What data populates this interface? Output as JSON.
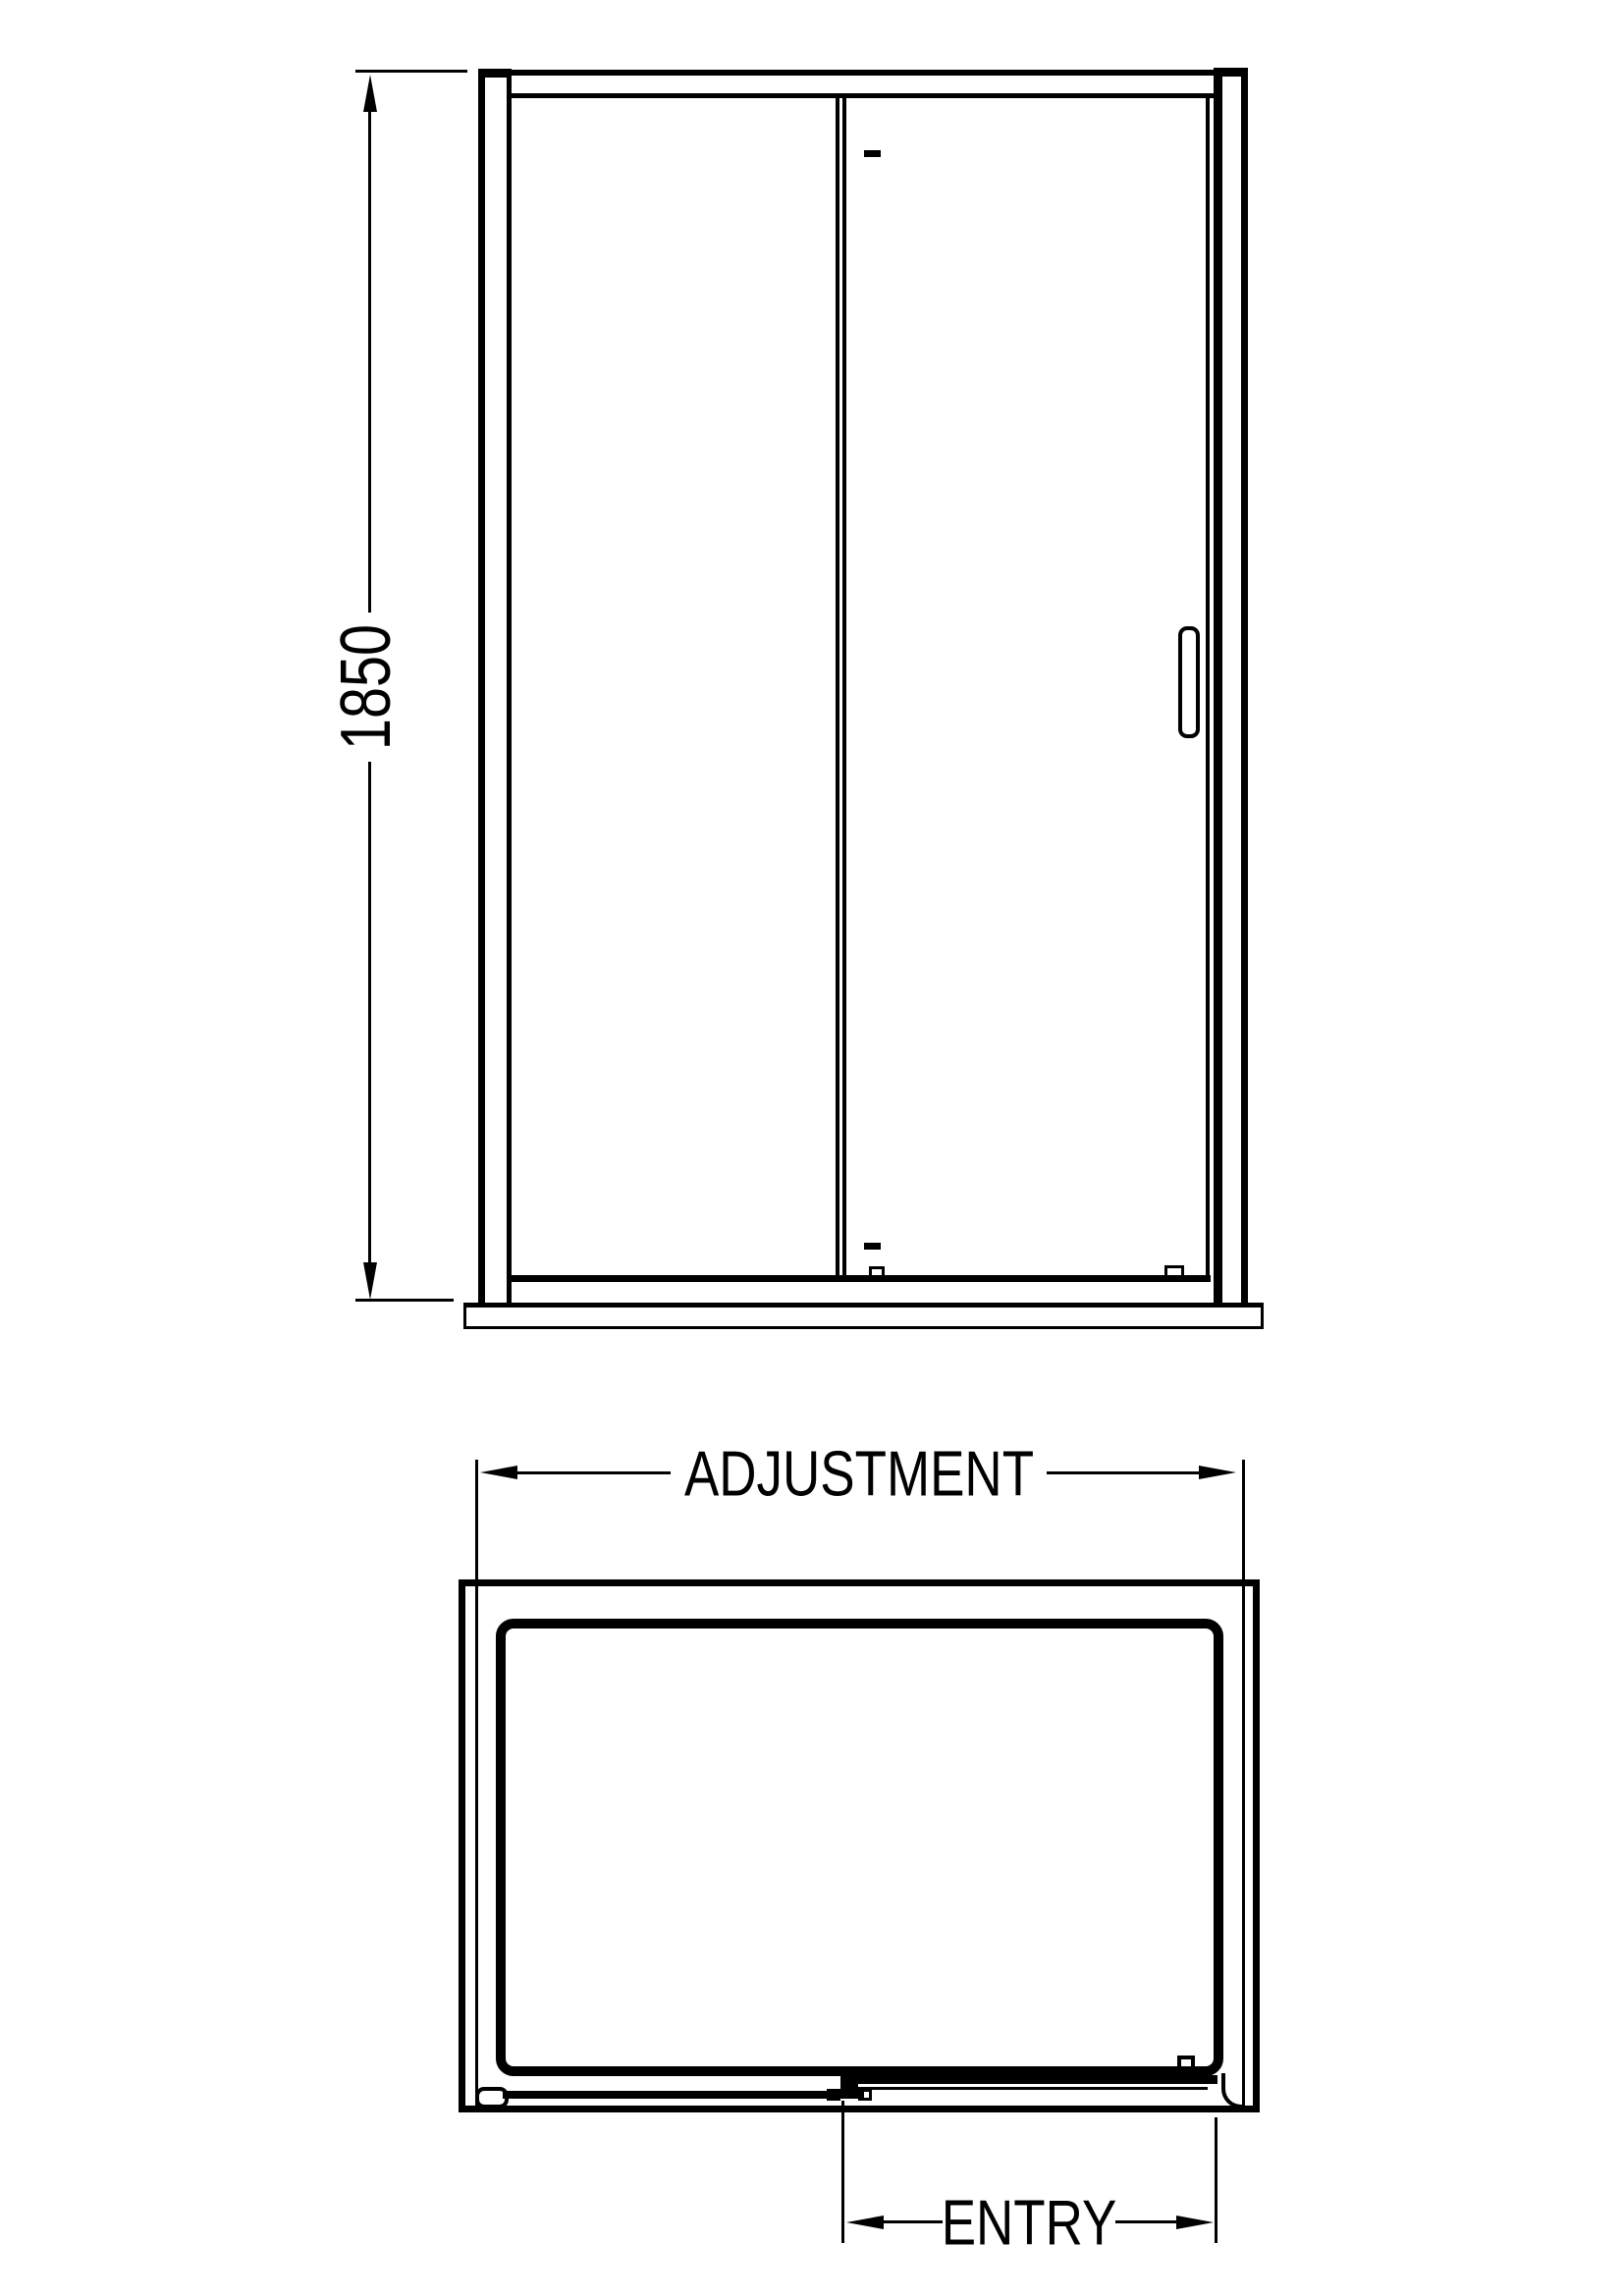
{
  "drawing": {
    "type": "shower-enclosure-technical-drawing",
    "background_color": "#ffffff",
    "line_color": "#000000",
    "front_view": {
      "height_dimension": {
        "label": "1850"
      }
    },
    "plan_view": {
      "width_dimension": {
        "label": "ADJUSTMENT"
      },
      "entry_dimension": {
        "label": "ENTRY"
      }
    }
  }
}
